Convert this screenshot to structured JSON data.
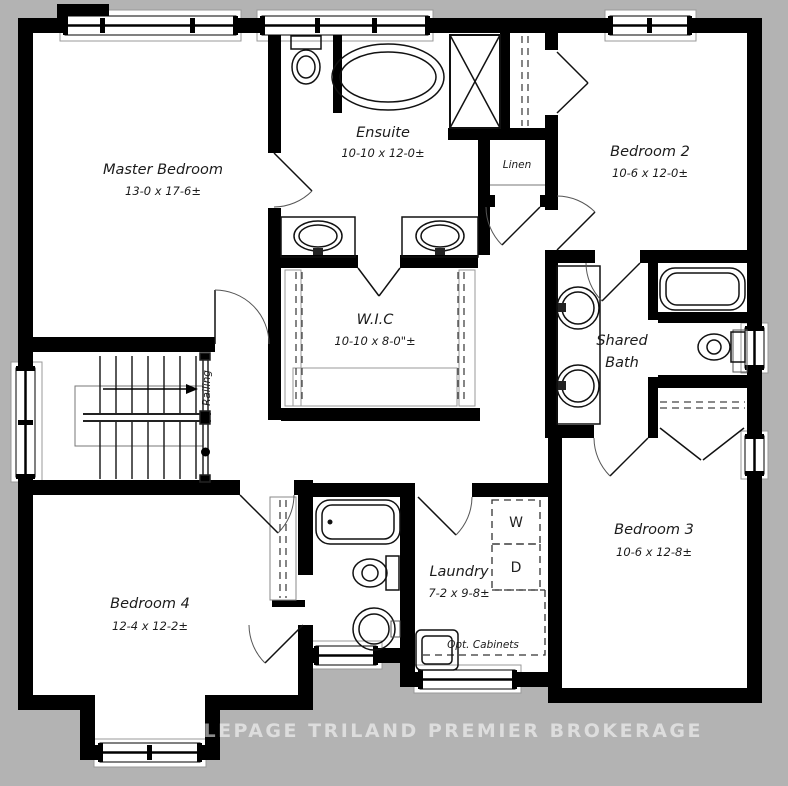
{
  "plan": {
    "watermark": "ROYAL LEPAGE TRILAND PREMIER BROKERAGE",
    "rooms": {
      "master_bedroom": {
        "name": "Master Bedroom",
        "dims": "13-0 x 17-6±"
      },
      "ensuite": {
        "name": "Ensuite",
        "dims": "10-10 x 12-0±"
      },
      "bedroom2": {
        "name": "Bedroom 2",
        "dims": "10-6 x 12-0±"
      },
      "linen": {
        "name": "Linen"
      },
      "wic": {
        "name": "W.I.C",
        "dims": "10-10 x 8-0\"±"
      },
      "shared_bath": {
        "name_line1": "Shared",
        "name_line2": "Bath"
      },
      "bedroom3": {
        "name": "Bedroom 3",
        "dims": "10-6 x 12-8±"
      },
      "bedroom4": {
        "name": "Bedroom 4",
        "dims": "12-4 x 12-2±"
      },
      "laundry": {
        "name": "Laundry",
        "dims": "7-2 x 9-8±"
      }
    },
    "annotations": {
      "railing": "Railing",
      "opt_cabinets": "Opt. Cabinets",
      "washer": "W",
      "dryer": "D"
    },
    "colors": {
      "background": "#b3b3b3",
      "walls": "#000000",
      "floor": "#ffffff",
      "watermark_text": "rgba(255,255,255,0.55)"
    }
  }
}
